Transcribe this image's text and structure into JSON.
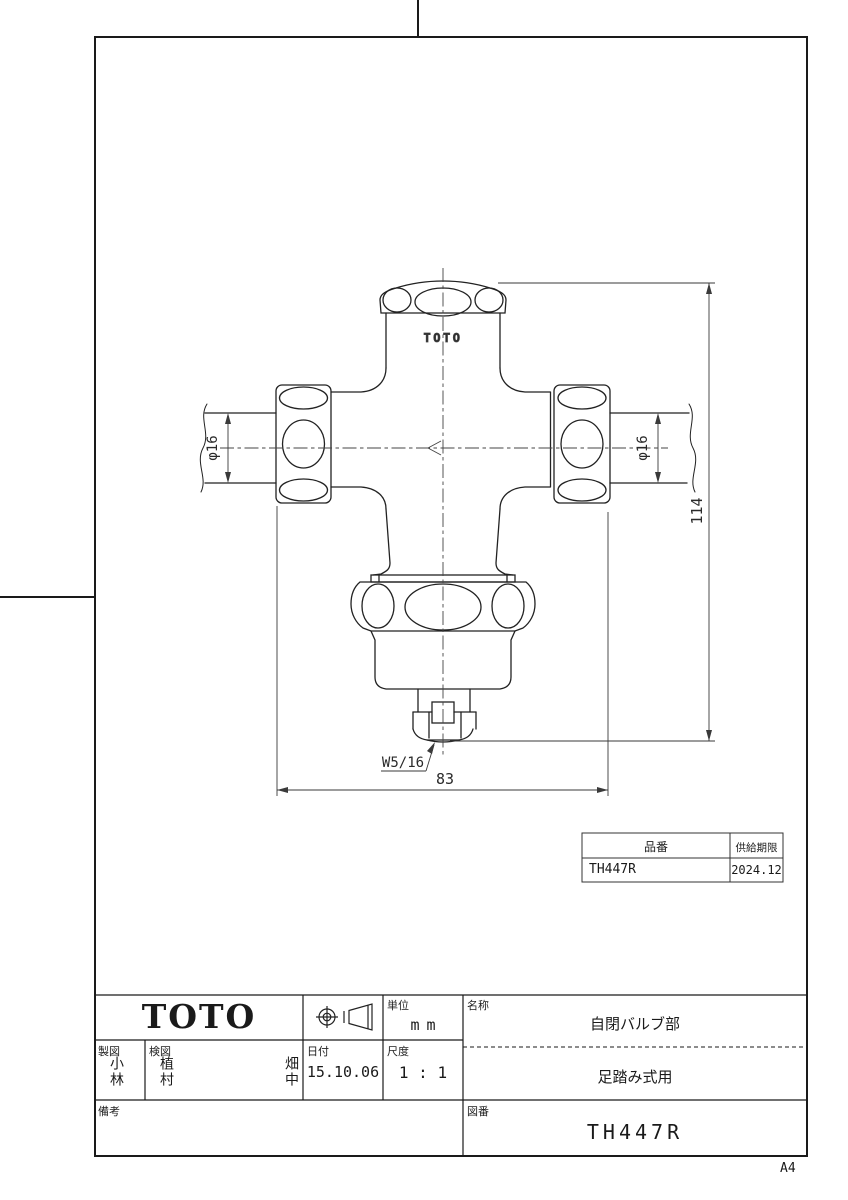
{
  "page": {
    "size_label": "A4"
  },
  "drawing": {
    "brand_on_part": "TOTO",
    "dim_height": "114",
    "dim_width": "83",
    "dim_left_dia": "φ16",
    "dim_right_dia": "φ16",
    "thread": "W5/16"
  },
  "part_table": {
    "headers": [
      "品番",
      "供給期限"
    ],
    "rows": [
      [
        "TH447R",
        "2024.12"
      ]
    ]
  },
  "title_block": {
    "logo": "TOTO",
    "unit_label": "単位",
    "unit_value": "mm",
    "name_label": "名称",
    "name_value": "自閉バルブ部",
    "name_sub": "足踏み式用",
    "drafted_label": "製図",
    "drafted_value": "小林",
    "checked_label": "検図",
    "checked_value1": "植村",
    "checked_value2": "畑中",
    "date_label": "日付",
    "date_value": "15.10.06",
    "scale_label": "尺度",
    "scale_value": "1 : 1",
    "remarks_label": "備考",
    "remarks_value": "",
    "drawing_no_label": "図番",
    "drawing_no_value": "TH447R"
  }
}
